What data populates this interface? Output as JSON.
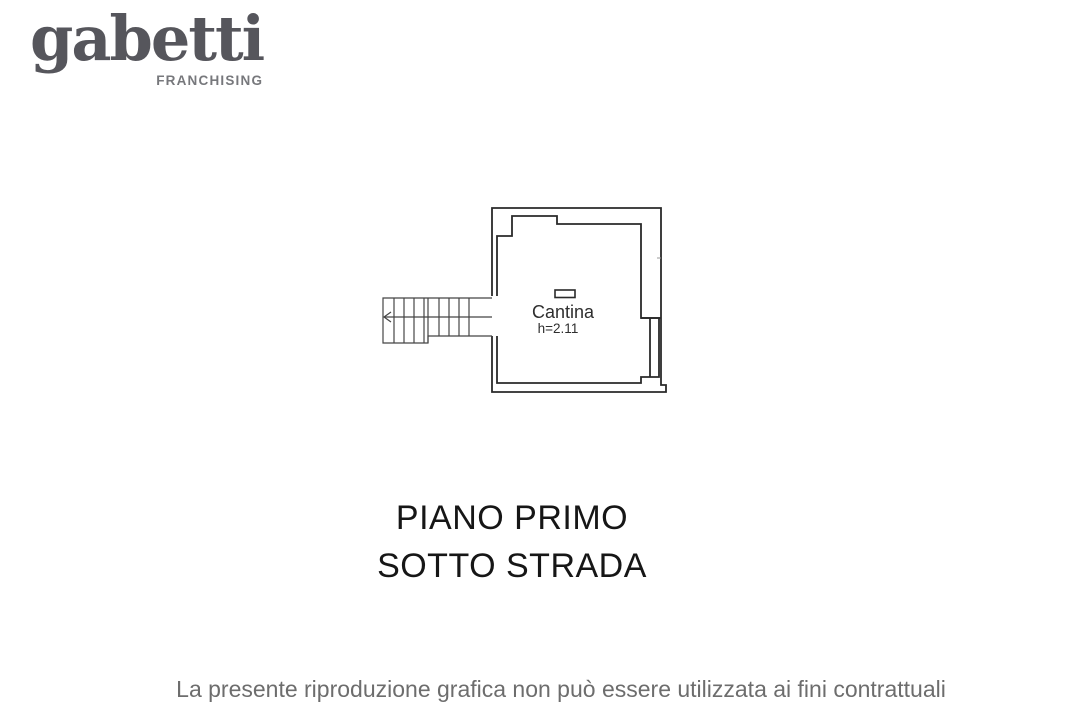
{
  "page": {
    "background": "#ffffff"
  },
  "logo": {
    "brand": "gabetti",
    "subtitle": "FRANCHISING",
    "brand_color": "#56565c",
    "subtitle_color": "#77787c"
  },
  "floor_plan": {
    "room_label": "Cantina",
    "room_height": "h=2.11",
    "wall_color": "#2a2a2a",
    "stair_color": "#454545",
    "label_color": "#2e2e2e"
  },
  "title": {
    "line1": "PIANO PRIMO",
    "line2": "SOTTO STRADA",
    "color": "#161616"
  },
  "footer": {
    "disclaimer": "La presente riproduzione grafica non può essere utilizzata ai fini contrattuali",
    "color": "#6d6d6d"
  }
}
